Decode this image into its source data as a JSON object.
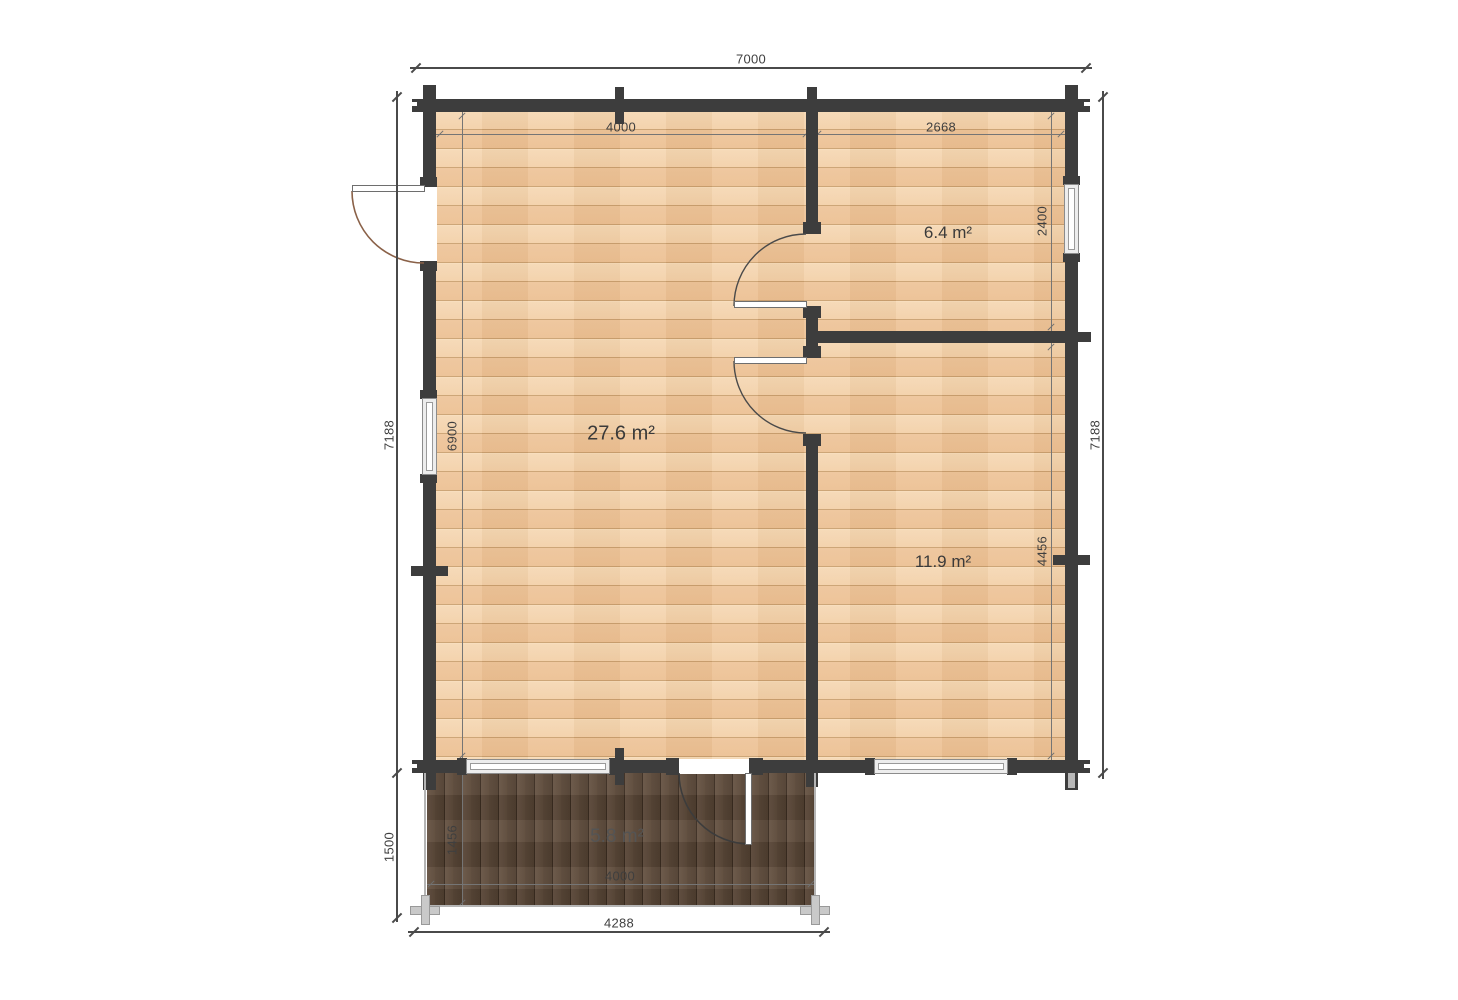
{
  "plan": {
    "type": "log-cabin floor plan",
    "colors": {
      "wall": "#3d3d3d",
      "floor_interior": "#f1cda6",
      "floor_terrace": "#5d4b3c",
      "dimension_line": "#4a4a4a",
      "exterior_door_arc": "#8a6148",
      "interior_door_arc": "#4a4a4a"
    }
  },
  "rooms": [
    {
      "id": "living",
      "area_label": "27.6 m²"
    },
    {
      "id": "top_right",
      "area_label": "6.4 m²"
    },
    {
      "id": "bottom_right",
      "area_label": "11.9 m²"
    },
    {
      "id": "terrace",
      "area_label": "5.8 m²"
    }
  ],
  "dimensions": {
    "overall_width": "7000",
    "room_left_width": "4000",
    "room_right_width": "2668",
    "room_topright_depth": "2400",
    "overall_depth_left": "7188",
    "overall_depth_right": "7188",
    "interior_depth": "6900",
    "room_bottomright_depth": "4456",
    "terrace_depth_overall": "1500",
    "terrace_depth_interior": "1456",
    "terrace_width_interior": "4000",
    "terrace_width_overall": "4288"
  }
}
